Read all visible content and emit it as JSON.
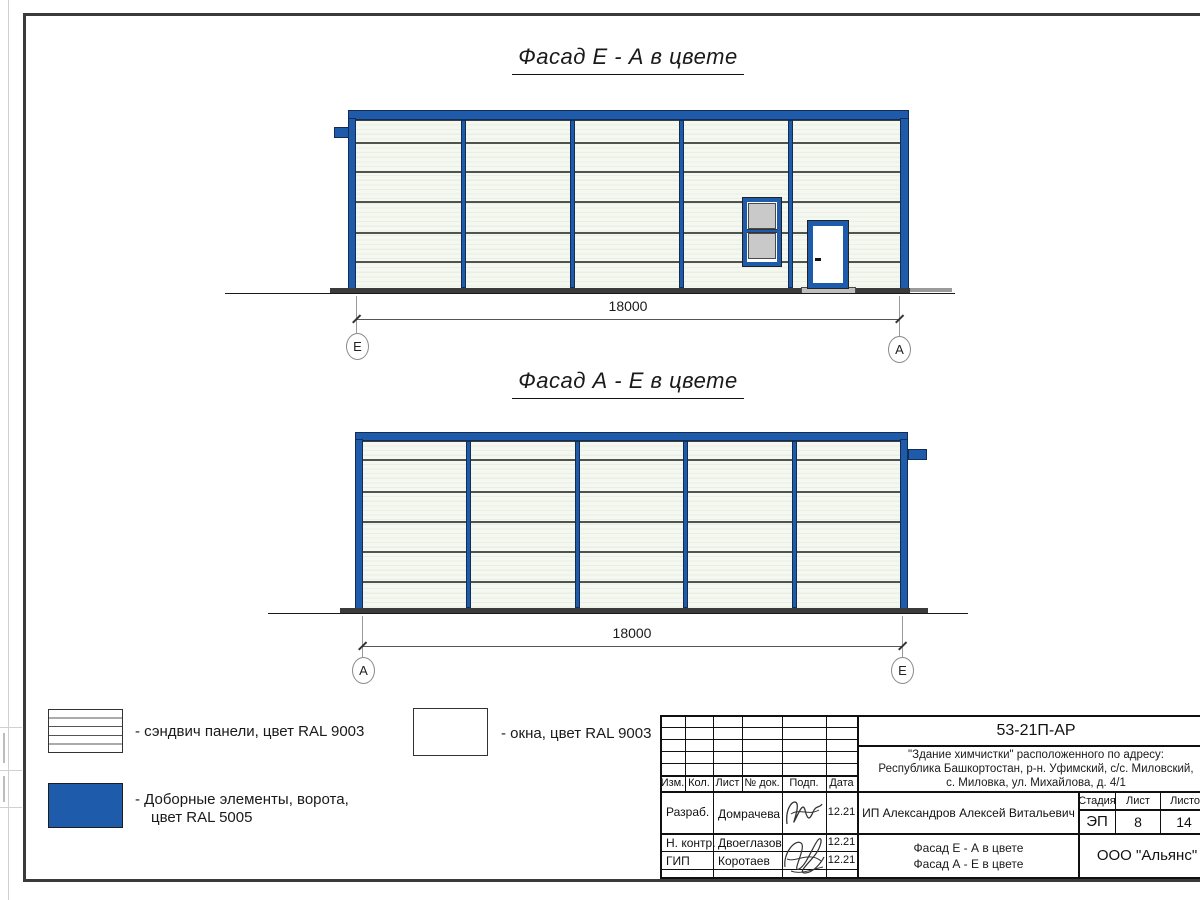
{
  "drawing": {
    "facade1": {
      "title": "Фасад Е - А в цвете",
      "dimension": "18000",
      "axis_left": "Е",
      "axis_right": "А"
    },
    "facade2": {
      "title": "Фасад А - Е в цвете",
      "dimension": "18000",
      "axis_left": "А",
      "axis_right": "Е"
    }
  },
  "legend": {
    "sandwich_label": "- сэндвич панели, цвет RAL 9003",
    "windows_label": "- окна, цвет RAL 9003",
    "extras_label_line1": "- Доборные элементы, ворота,",
    "extras_label_line2": "цвет RAL 5005"
  },
  "title_block": {
    "doc_number": "53-21П-АР",
    "address_line1": "\"Здание химчистки\" расположенного по адресу:",
    "address_line2": "Республика Башкортостан, р-н. Уфимский, с/с. Миловский,",
    "address_line3": "с. Миловка, ул. Михайлова, д. 4/1",
    "columns": [
      "Изм.",
      "Кол.",
      "Лист",
      "№ док.",
      "Подп.",
      "Дата"
    ],
    "rows": [
      {
        "role": "Разраб.",
        "name": "Домрачева",
        "date": "12.21"
      },
      {
        "role": "Н. контр.",
        "name": "Двоеглазов",
        "date": "12.21"
      },
      {
        "role": "ГИП",
        "name": "Коротаев",
        "date": "12.21"
      }
    ],
    "client": "ИП Александров Алексей Витальевич",
    "stage_label": "Стадия",
    "sheet_label": "Лист",
    "sheets_label": "Листов",
    "stage": "ЭП",
    "sheet": "8",
    "sheets": "14",
    "sheet_title_line1": "Фасад Е - А в цвете",
    "sheet_title_line2": "Фасад А - Е в цвете",
    "company": "ООО \"Альянс\""
  },
  "colors": {
    "accent_blue_ral5005": "#1f5bab",
    "panel_fill_ral9003": "#f4f8f0",
    "base_dark": "#3b3b3b"
  }
}
